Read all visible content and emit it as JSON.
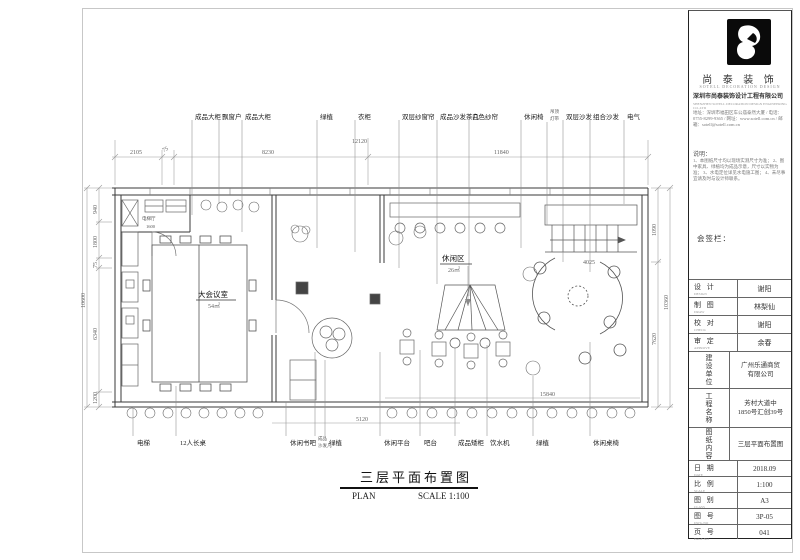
{
  "brand": {
    "name_cn": "尚 泰 装 饰",
    "name_en": "SOTELL DECORATION DESIGN",
    "company_line1": "深圳市尚泰装饰设计工程有限公司",
    "company_line2": "SHENZHEN SOTELL DECORATION DESIGN ENGINEERING CO.,LTD",
    "info_lines": "地址：深圳市福田区车公庙泰然大厦 / 电话：0755-8299-9365 / 网址：www.sotell.com.cn / 邮箱：sotell@sotell.com.cn",
    "notes_title": "说明：",
    "notes": "1、本图纸尺寸均以现场实测尺寸为准； 2、图中家具、绿植均为成品示意，尺寸以实物为准； 3、水电定位详见水电施工图； 4、未尽事宜请及时与设计师联系。"
  },
  "titleblock": {
    "signoff": "会签栏：",
    "rows": [
      {
        "label": "设 计",
        "sub": "DESIGN",
        "value": "谢阳"
      },
      {
        "label": "制 图",
        "sub": "DRAW",
        "value": "林梨仙"
      },
      {
        "label": "校 对",
        "sub": "CHECK",
        "value": "谢阳"
      },
      {
        "label": "审 定",
        "sub": "APPROVE",
        "value": "余春"
      }
    ],
    "client": {
      "label": "建设单位",
      "value1": "广州乐通商贸",
      "value2": "有限公司"
    },
    "project": {
      "label": "工程名称",
      "value1": "芳村大道中",
      "value2": "1850号汇创39号"
    },
    "content": {
      "label": "图纸内容",
      "value1": "三层平面布置图",
      "value2": ""
    },
    "meta": [
      {
        "label": "日 期",
        "sub": "DATE",
        "value": "2018.09"
      },
      {
        "label": "比 例",
        "sub": "SCALE",
        "value": "1:100"
      },
      {
        "label": "图 别",
        "sub": "CLASS",
        "value": "A3"
      },
      {
        "label": "图 号",
        "sub": "DWG.NO",
        "value": "3P-05"
      },
      {
        "label": "页 号",
        "sub": "PAGE.NO",
        "value": "041"
      }
    ]
  },
  "plan": {
    "top_labels": [
      "成品大柜",
      "飘窗户",
      "成品大柜",
      "绿植",
      "衣柜",
      "双层纱窗帘",
      "成品沙发茶几",
      "白色纱帘",
      "休闲椅",
      "吊顶",
      "灯带",
      "双层沙发",
      "组合沙发",
      "电气"
    ],
    "bottom_labels": [
      "电梯",
      "12人长桌",
      "休闲书吧",
      "成品",
      "沙发几",
      "绿植",
      "休闲平台",
      "吧台",
      "成品矮柜",
      "饮水机",
      "绿植",
      "休闲桌椅"
    ],
    "rooms": [
      {
        "name": "大会议室",
        "area": "54㎡"
      },
      {
        "name": "休闲区",
        "area": "26㎡"
      }
    ],
    "inner_labels": {
      "elevator": "电梯厅",
      "elevator_dim": "1600",
      "stair_dim": "4025"
    },
    "dims": {
      "top": [
        "2105",
        "75",
        "8230",
        "11840",
        "12120"
      ],
      "left": [
        "940",
        "1800",
        "75",
        "6340",
        "1200",
        "10600"
      ],
      "right": [
        "1090",
        "7620",
        "10360"
      ],
      "bottom": [
        "5120",
        "15840"
      ]
    }
  },
  "caption": {
    "title": "三层平面布置图",
    "plan": "PLAN",
    "scale": "SCALE 1:100"
  }
}
